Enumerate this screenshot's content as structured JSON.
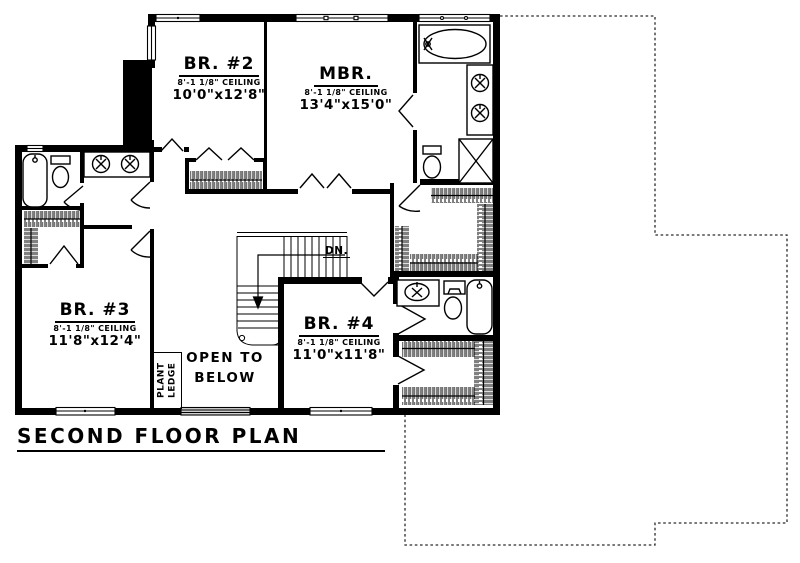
{
  "plan": {
    "title": "SECOND FLOOR PLAN",
    "rooms": [
      {
        "id": "br2",
        "name": "BR. #2",
        "ceiling": "8'-1 1/8\" CEILING",
        "dims": "10'0\"x12'8\""
      },
      {
        "id": "mbr",
        "name": "MBR.",
        "ceiling": "8'-1 1/8\" CEILING",
        "dims": "13'4\"x15'0\""
      },
      {
        "id": "br3",
        "name": "BR. #3",
        "ceiling": "8'-1 1/8\" CEILING",
        "dims": "11'8\"x12'4\""
      },
      {
        "id": "br4",
        "name": "BR. #4",
        "ceiling": "8'-1 1/8\" CEILING",
        "dims": "11'0\"x11'8\""
      }
    ],
    "labels": {
      "open_below_line1": "OPEN TO",
      "open_below_line2": "BELOW",
      "plant_ledge_line1": "PLANT",
      "plant_ledge_line2": "LEDGE",
      "stairs_direction": "DN."
    },
    "colors": {
      "ink": "#000000",
      "paper": "#ffffff"
    }
  }
}
